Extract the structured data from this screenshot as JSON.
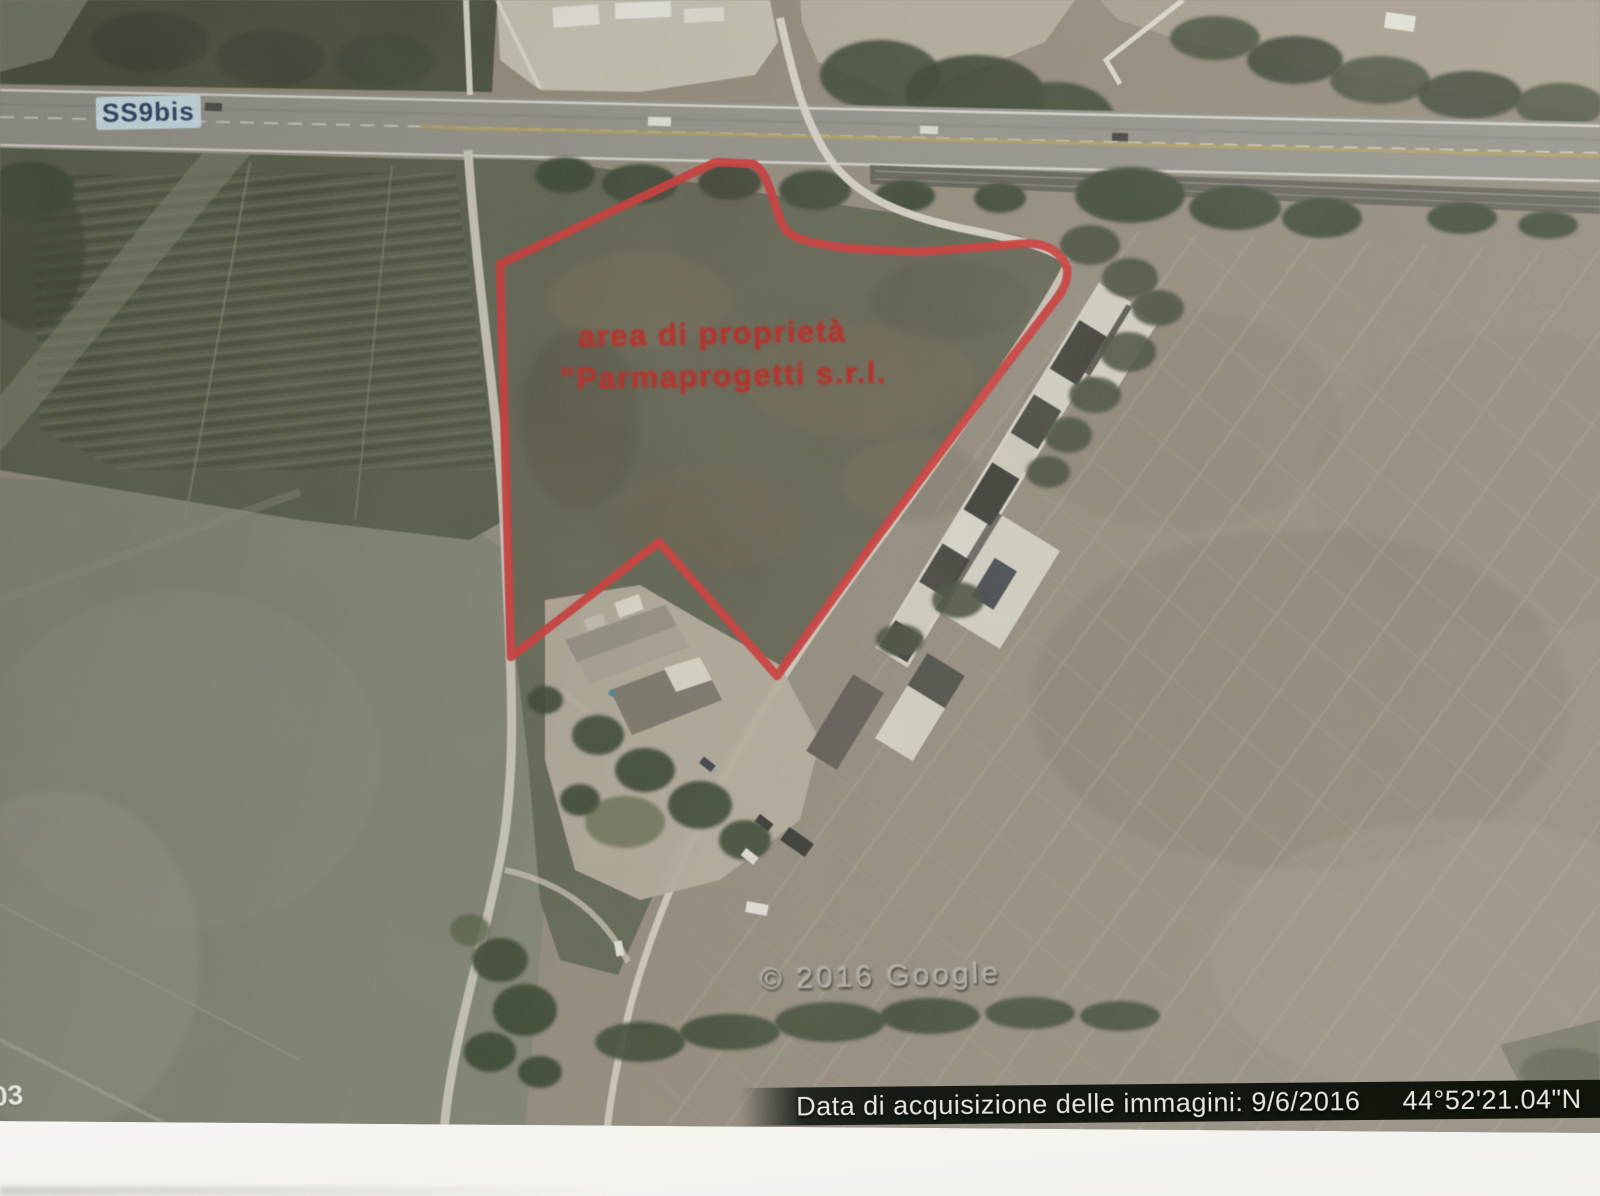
{
  "photo": {
    "road_label": "SS9bis",
    "annotation": {
      "line1": "area di proprietà",
      "line2": "\"Parmaprogetti s.r.l.",
      "color": "#b3362f"
    },
    "watermark": "© 2016 Google",
    "status_bar": {
      "acquisition": "Data di acquisizione delle immagini: 9/6/2016",
      "latitude": "44°52'21.04\"N",
      "longitude": "10°03'",
      "background": "#161a14",
      "text_color": "#e9e7e1"
    },
    "corner_fragment": "03",
    "colors": {
      "property_outline": "#c93230",
      "paper": "#fafaf8"
    }
  }
}
